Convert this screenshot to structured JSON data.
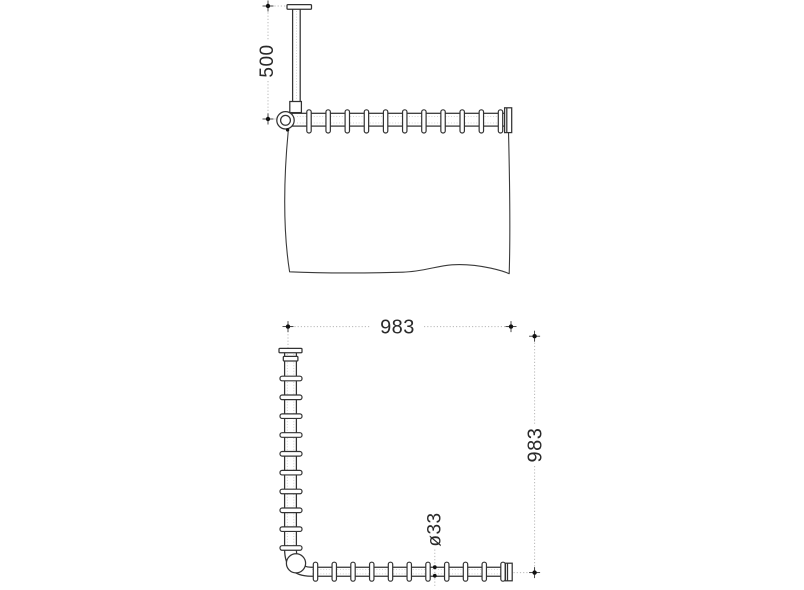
{
  "front_view": {
    "drop_label": "500",
    "ring_count": 11
  },
  "plan_view": {
    "width_label": "983",
    "depth_label": "983",
    "diameter_label": "ø33",
    "rail_ring_count": 11,
    "side_ring_count": 10
  },
  "colors": {
    "line": "#333333",
    "dim_line": "#b8b8b8",
    "text": "#2a2a2a",
    "background": "#ffffff"
  }
}
